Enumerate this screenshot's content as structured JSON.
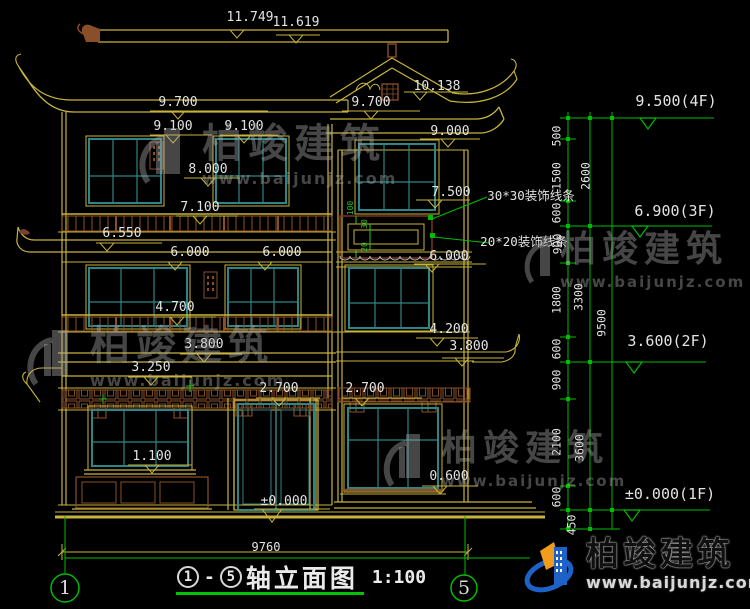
{
  "colors": {
    "line_yellow": "#c8b43c",
    "frame_teal": "#2e8585",
    "wood_brown": "#8a4f28",
    "accent_green": "#00bb00",
    "text_white": "#e3e3e3",
    "background": "#000000",
    "brand_blue": "#1e62c8",
    "brand_orange": "#f09c1e"
  },
  "title_block": {
    "axis_from": "1",
    "dash": "-",
    "axis_to": "5",
    "title": "轴立面图",
    "scale": "1:100"
  },
  "axis_bubbles": {
    "left": "1",
    "right": "5"
  },
  "watermark": {
    "name": "柏竣建筑",
    "url": "www.baijunjz.com"
  },
  "brand": {
    "name": "柏竣建筑",
    "url": "www.baijunjz.com"
  },
  "labels": [
    {
      "t": "11.749",
      "x": 250,
      "y": 11,
      "n": "dim-11749"
    },
    {
      "t": "11.619",
      "x": 296,
      "y": 16,
      "n": "dim-11619"
    },
    {
      "t": "10.138",
      "x": 437,
      "y": 80,
      "n": "dim-10138"
    },
    {
      "t": "9.700",
      "x": 178,
      "y": 96,
      "n": "dim-9700-left"
    },
    {
      "t": "9.700",
      "x": 371,
      "y": 96,
      "n": "dim-9700-right"
    },
    {
      "t": "9.100",
      "x": 173,
      "y": 120,
      "n": "dim-9100-left"
    },
    {
      "t": "9.100",
      "x": 244,
      "y": 120,
      "n": "dim-9100-right"
    },
    {
      "t": "9.000",
      "x": 450,
      "y": 125,
      "n": "dim-9000"
    },
    {
      "t": "8.000",
      "x": 208,
      "y": 163,
      "n": "dim-8000"
    },
    {
      "t": "7.500",
      "x": 451,
      "y": 186,
      "n": "dim-7500"
    },
    {
      "t": "7.100",
      "x": 200,
      "y": 201,
      "n": "dim-7100"
    },
    {
      "t": "6.550",
      "x": 122,
      "y": 227,
      "n": "dim-6550"
    },
    {
      "t": "6.000",
      "x": 190,
      "y": 246,
      "n": "dim-6000-left"
    },
    {
      "t": "6.000",
      "x": 282,
      "y": 246,
      "n": "dim-6000-mid"
    },
    {
      "t": "6.000",
      "x": 449,
      "y": 250,
      "n": "dim-6000-wing"
    },
    {
      "t": "4.700",
      "x": 175,
      "y": 301,
      "n": "dim-4700"
    },
    {
      "t": "4.200",
      "x": 449,
      "y": 323,
      "n": "dim-4200"
    },
    {
      "t": "3.800",
      "x": 204,
      "y": 338,
      "n": "dim-3800-left"
    },
    {
      "t": "3.800",
      "x": 469,
      "y": 340,
      "n": "dim-3800-wing"
    },
    {
      "t": "3.250",
      "x": 151,
      "y": 361,
      "n": "dim-3250"
    },
    {
      "t": "2.700",
      "x": 279,
      "y": 382,
      "n": "dim-2700-left"
    },
    {
      "t": "2.700",
      "x": 365,
      "y": 382,
      "n": "dim-2700-wing"
    },
    {
      "t": "1.100",
      "x": 152,
      "y": 450,
      "n": "dim-1100"
    },
    {
      "t": "0.600",
      "x": 449,
      "y": 470,
      "n": "dim-0600"
    },
    {
      "t": "±0.000",
      "x": 284,
      "y": 495,
      "n": "dim-zero"
    },
    {
      "t": "9760",
      "x": 266,
      "y": 541,
      "k": "small",
      "n": "dim-overall-width"
    },
    {
      "t": "9.500(4F)",
      "x": 676,
      "y": 94,
      "k": "level",
      "n": "level-4f"
    },
    {
      "t": "6.900(3F)",
      "x": 675,
      "y": 204,
      "k": "level",
      "n": "level-3f"
    },
    {
      "t": "3.600(2F)",
      "x": 668,
      "y": 334,
      "k": "level",
      "n": "level-2f"
    },
    {
      "t": "±0.000(1F)",
      "x": 670,
      "y": 487,
      "k": "level",
      "n": "level-1f"
    },
    {
      "t": "30*30装饰线条",
      "x": 531,
      "y": 190,
      "k": "note",
      "n": "note-trim-30"
    },
    {
      "t": "20*20装饰线条",
      "x": 524,
      "y": 236,
      "k": "note",
      "n": "note-trim-20"
    },
    {
      "t": "500",
      "x": 557,
      "y": 136,
      "r": 1,
      "k": "chain",
      "n": "chain-500"
    },
    {
      "t": "1500",
      "x": 557,
      "y": 176,
      "r": 1,
      "k": "chain",
      "n": "chain-1500"
    },
    {
      "t": "2600",
      "x": 586,
      "y": 176,
      "r": 1,
      "k": "chain",
      "n": "chain-2600"
    },
    {
      "t": "600",
      "x": 557,
      "y": 213,
      "r": 1,
      "k": "chain",
      "n": "chain-600a"
    },
    {
      "t": "900",
      "x": 558,
      "y": 244,
      "r": 1,
      "k": "chain",
      "n": "chain-900a"
    },
    {
      "t": "1800",
      "x": 557,
      "y": 300,
      "r": 1,
      "k": "chain",
      "n": "chain-1800"
    },
    {
      "t": "3300",
      "x": 579,
      "y": 297,
      "r": 1,
      "k": "chain",
      "n": "chain-3300"
    },
    {
      "t": "9500",
      "x": 602,
      "y": 323,
      "r": 1,
      "k": "chain",
      "n": "chain-9500"
    },
    {
      "t": "600",
      "x": 557,
      "y": 349,
      "r": 1,
      "k": "chain",
      "n": "chain-600b"
    },
    {
      "t": "900",
      "x": 557,
      "y": 380,
      "r": 1,
      "k": "chain",
      "n": "chain-900b"
    },
    {
      "t": "2100",
      "x": 557,
      "y": 442,
      "r": 1,
      "k": "chain",
      "n": "chain-2100"
    },
    {
      "t": "3600",
      "x": 580,
      "y": 448,
      "r": 1,
      "k": "chain",
      "n": "chain-3600"
    },
    {
      "t": "600",
      "x": 557,
      "y": 497,
      "r": 1,
      "k": "chain",
      "n": "chain-600c"
    },
    {
      "t": "450",
      "x": 572,
      "y": 525,
      "r": 1,
      "k": "chain",
      "n": "chain-450"
    },
    {
      "t": "100",
      "x": 351,
      "y": 208,
      "r": 1,
      "k": "tiny",
      "n": "detail-100"
    },
    {
      "t": "30",
      "x": 365,
      "y": 224,
      "r": 1,
      "k": "tiny",
      "n": "detail-30"
    },
    {
      "t": "20",
      "x": 365,
      "y": 247,
      "r": 1,
      "k": "tiny",
      "n": "detail-20"
    }
  ]
}
